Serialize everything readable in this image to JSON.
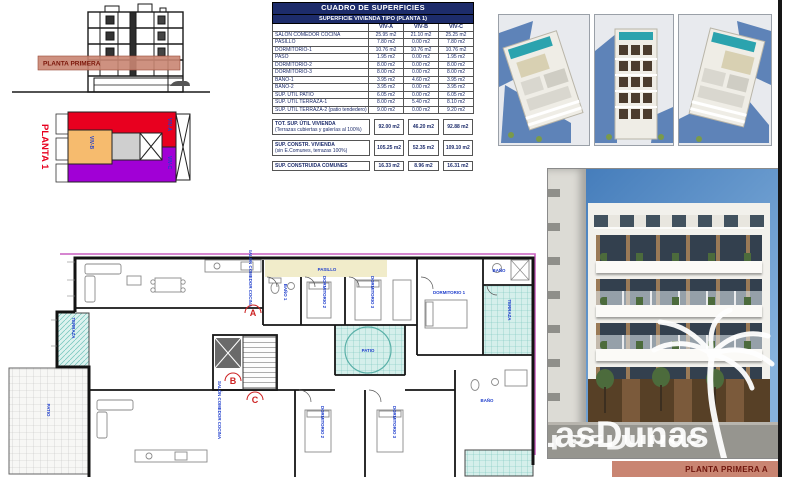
{
  "section": {
    "band_label": "PLANTA PRIMERA"
  },
  "key_plan": {
    "title": "PLANTA 1",
    "viv_a": "VIV-A",
    "viv_b": "VIV-B",
    "viv_c": "VIV-C"
  },
  "table": {
    "title": "CUADRO DE SUPERFICIES",
    "subtitle": "SUPERFICIE VIVIENDA TIPO (PLANTA 1)",
    "col_a": "VIV-A",
    "col_b": "VIV-B",
    "col_c": "VIV-C",
    "rows": [
      {
        "label": "SALÓN COMEDOR COCINA",
        "a": "25.95 m2",
        "b": "21.10 m2",
        "c": "25.25 m2"
      },
      {
        "label": "PASILLO",
        "a": "7.80 m2",
        "b": "0.00 m2",
        "c": "7.80 m2"
      },
      {
        "label": "DORMITORIO-1",
        "a": "10.76 m2",
        "b": "10.76 m2",
        "c": "10.76 m2"
      },
      {
        "label": "PASO",
        "a": "1.95 m2",
        "b": "0.00 m2",
        "c": "1.95 m2"
      },
      {
        "label": "DORMITORIO-2",
        "a": "8.00 m2",
        "b": "0.00 m2",
        "c": "8.00 m2"
      },
      {
        "label": "DORMITORIO-3",
        "a": "8.00 m2",
        "b": "0.00 m2",
        "c": "8.00 m2"
      },
      {
        "label": "BAÑO-1",
        "a": "3.95 m2",
        "b": "4.60 m2",
        "c": "3.95 m2"
      },
      {
        "label": "BAÑO-2",
        "a": "3.95 m2",
        "b": "0.00 m2",
        "c": "3.95 m2"
      },
      {
        "label": "SUP. ÚTIL PATIO",
        "a": "6.05 m2",
        "b": "0.00 m2",
        "c": "6.05 m2"
      },
      {
        "label": "SUP. ÚTIL TERRAZA-1",
        "a": "8.00 m2",
        "b": "5.40 m2",
        "c": "8.10 m2"
      },
      {
        "label": "SUP. ÚTIL TERRAZA-2 (patio tendedero)",
        "a": "9.00 m2",
        "b": "0.00 m2",
        "c": "9.20 m2"
      }
    ],
    "totals": [
      {
        "label": "TOT. SUP. ÚTIL VIVIENDA",
        "note": "(Terrazas cubiertas y galerías al 100%)",
        "a": "92.00 m2",
        "b": "46.20 m2",
        "c": "92.88 m2"
      },
      {
        "label": "SUP. CONSTR. VIVIENDA",
        "note": "(sin E.Comunes, terrazas 100%)",
        "a": "105.25 m2",
        "b": "52.35 m2",
        "c": "109.10 m2"
      },
      {
        "label": "SUP. CONSTRUIDA COMUNES",
        "note": "",
        "a": "16.33 m2",
        "b": "8.96 m2",
        "c": "16.31 m2"
      }
    ]
  },
  "plan": {
    "labels": {
      "terraza_left": "TERRAZA",
      "patio_left": "PATIO",
      "salon_a": "SALÓN COMEDOR COCINA",
      "pasillo": "PASILLO",
      "bano_1": "BAÑO 1",
      "dormitorio_2": "DORMITORIO 2",
      "dormitorio_3": "DORMITORIO 3",
      "dormitorio_1": "DORMITORIO 1",
      "bano_b": "BAÑO",
      "terraza_right": "TERRAZA",
      "patio": "PATIO",
      "salon_c": "SALÓN COMEDOR COCINA",
      "dormitorio_c1": "DORMITORIO 2",
      "dormitorio_c2": "DORMITORIO 3",
      "bano_c": "BAÑO"
    },
    "markers": {
      "a": "A",
      "b": "B",
      "c": "C"
    }
  },
  "watermark": {
    "brand": "LasDunas"
  },
  "footer": {
    "label": "PLANTA PRIMERA A"
  },
  "colors": {
    "navy": "#1d2c6b",
    "salmon": "#c98572",
    "band_text": "#7a1508",
    "unit_red": "#e8001f",
    "unit_purple": "#a100d6",
    "unit_orange": "#f6bb6e",
    "teal": "#6fc2ba",
    "label_blue": "#1f3ecc",
    "marker_red": "#cc2222",
    "sky": "#3f78b8"
  }
}
